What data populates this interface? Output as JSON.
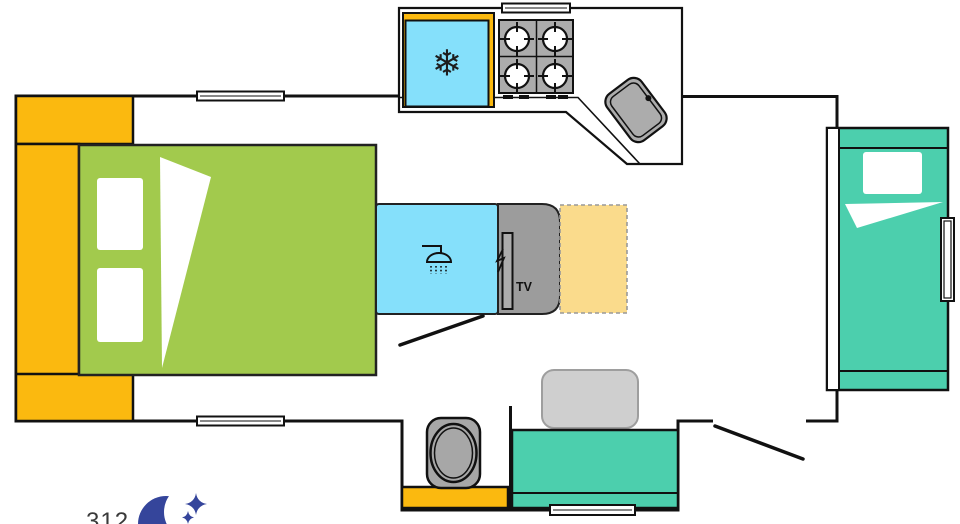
{
  "labels": {
    "tv": "TV",
    "model": "312"
  },
  "icons": {
    "snowflake": "❄",
    "moon": "crescent-moon",
    "stars": "four-point-stars",
    "shower": "shower-head",
    "burner": "stove-burner"
  },
  "colors": {
    "cabinet_orange": "#FBB90F",
    "bed_green": "#A2CA4D",
    "water_blue": "#85E0FB",
    "teal": "#4CCFAD",
    "wardrobe_tan": "#FADB8C",
    "appliance_gray": "#ACACAC",
    "tv_gray": "#9C9C9C",
    "toilet_gray": "#A7A7A7",
    "table_gray": "#CFCFCF",
    "logo_navy": "#35459B",
    "text_dark": "#3A3A3A",
    "wall_black": "#111111",
    "white": "#FFFFFF"
  }
}
